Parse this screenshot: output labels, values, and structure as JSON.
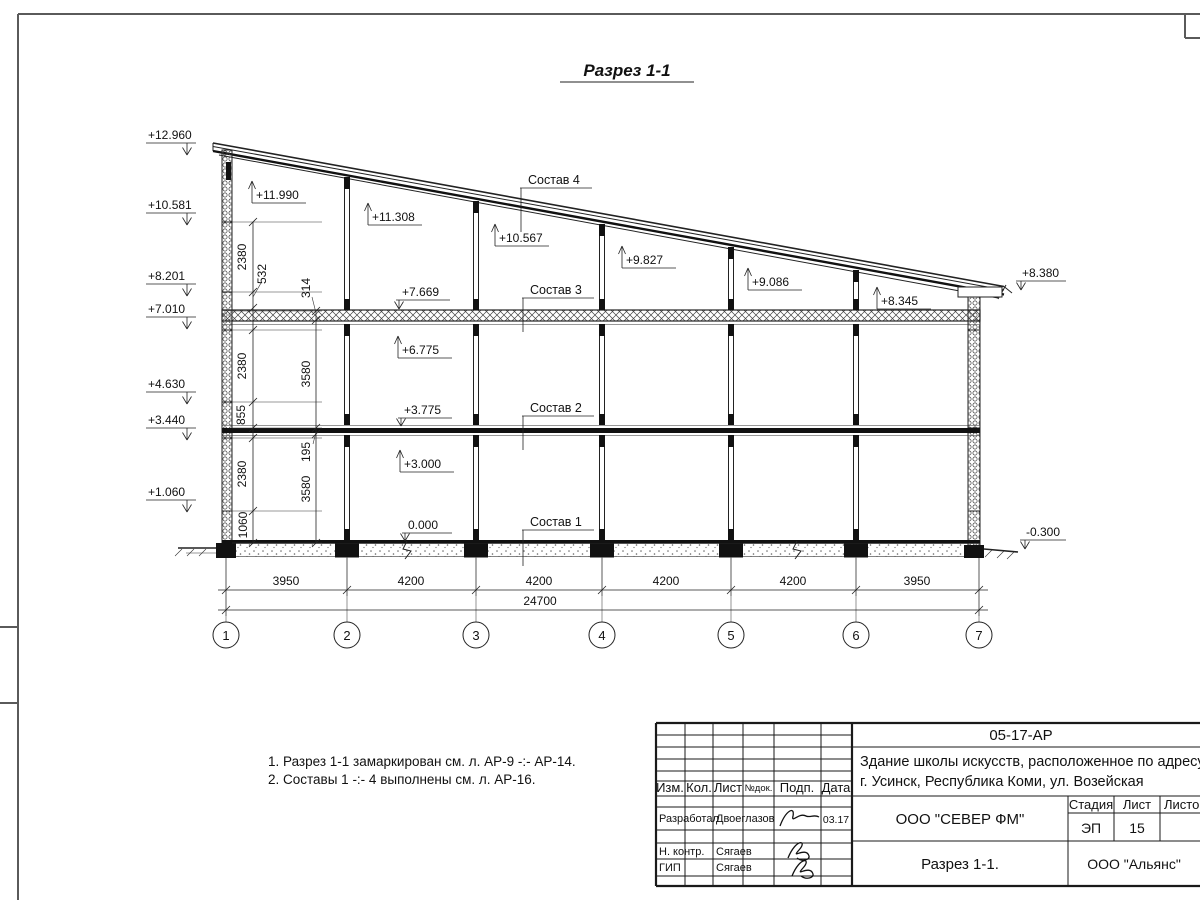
{
  "drawing": {
    "title": "Разрез 1-1",
    "marks_left": [
      "+12.960",
      "+10.581",
      "+8.201",
      "+7.010",
      "+4.630",
      "+3.440",
      "+1.060"
    ],
    "marks_up": [
      "+11.990",
      "+11.308",
      "+10.567",
      "+9.827",
      "+9.086",
      "+8.345",
      "+6.775",
      "+3.000"
    ],
    "marks_down": [
      "+7.669",
      "+3.775",
      "0.000"
    ],
    "marks_right": [
      "+8.380",
      "-0.300"
    ],
    "layers": [
      "Состав 4",
      "Состав 3",
      "Состав 2",
      "Состав 1"
    ],
    "dims_chain_a": [
      "2380",
      "532",
      "2380",
      "855",
      "2380",
      "1060"
    ],
    "dims_chain_b": [
      "314",
      "3580",
      "195",
      "3580"
    ],
    "dims_bottom": [
      "3950",
      "4200",
      "4200",
      "4200",
      "4200",
      "3950"
    ],
    "dim_total": "24700",
    "axes": [
      "1",
      "2",
      "3",
      "4",
      "5",
      "6",
      "7"
    ]
  },
  "notes": {
    "line1": "1. Разрез 1-1 замаркирован см. л. АР-9 -:- АР-14.",
    "line2": "2. Составы 1 -:- 4 выполнены см. л. АР-16."
  },
  "tb": {
    "code": "05-17-АР",
    "object1": "Здание школы искусств, расположенное по адресу:",
    "object2": "г. Усинск, Республика Коми, ул. Возейская",
    "cols": {
      "izm": "Изм.",
      "kol": "Кол.",
      "list": "Лист",
      "ndok": "№док.",
      "podp": "Подп.",
      "data": "Дата"
    },
    "r1": {
      "role": "Разработал",
      "name": "Двоеглазов",
      "date": "03.17"
    },
    "r2": {
      "role": "Н. контр.",
      "name": "Сягаев"
    },
    "r3": {
      "role": "ГИП",
      "name": "Сягаев"
    },
    "org": "ООО \"СЕВЕР ФМ\"",
    "stage_h": "Стадия",
    "list_h": "Лист",
    "listov_h": "Листов",
    "stage": "ЭП",
    "sheet": "15",
    "doc_title": "Разрез 1-1.",
    "org2": "ООО \"Альянс\""
  }
}
